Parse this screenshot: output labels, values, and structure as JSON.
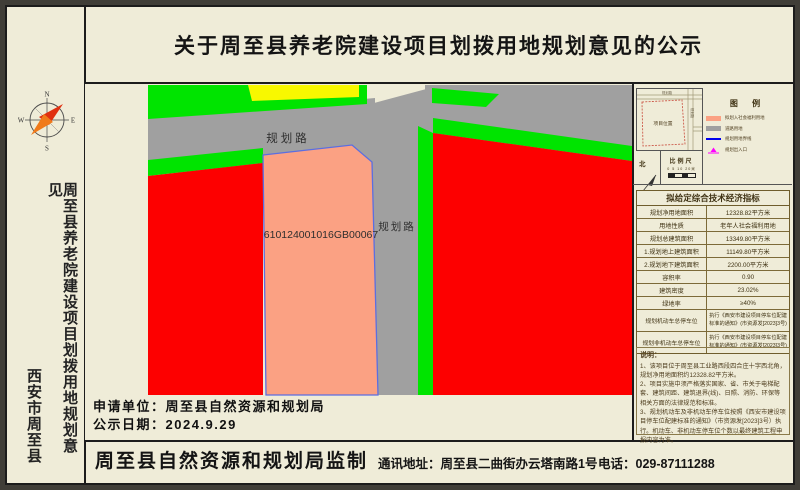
{
  "title": "关于周至县养老院建设项目划拨用地规划意见的公示",
  "sidebar": {
    "project_vertical": "周至县养老院建设项目划拨用地规划意见",
    "city_vertical": "西安市周至县",
    "compass": {
      "n": "N",
      "e": "E",
      "s": "S",
      "w": "W"
    }
  },
  "map": {
    "parcel_code": "610124001016GB00067",
    "road_top": "规划路",
    "road_right": "规划路"
  },
  "inset": {
    "label": "项目位置",
    "road_top": "规划路",
    "road_right": "规划路"
  },
  "north_label": "北",
  "scale": {
    "label": "比例尺",
    "ticks": "0 5 10  20米"
  },
  "legend": {
    "title": "图  例",
    "items": [
      {
        "swatch": "parcel-fill",
        "label": "拟划入社会福利用地"
      },
      {
        "swatch": "road-fill",
        "label": "道路用地"
      },
      {
        "swatch": "boundary-line",
        "label": "规划用地界线"
      },
      {
        "swatch": "entrance-symbol",
        "label": "规划出入口"
      }
    ]
  },
  "indicators": {
    "title": "拟给定综合技术经济指标",
    "rows": [
      {
        "label": "规划净用地面积",
        "value": "12328.82平方米"
      },
      {
        "label": "用地性质",
        "value": "老年人社会福利用地"
      },
      {
        "label": "规划总建筑面积",
        "value": "13349.80平方米"
      },
      {
        "label": "1.规划地上建筑面积",
        "value": "11149.80平方米"
      },
      {
        "label": "2.规划地下建筑面积",
        "value": "2200.00平方米"
      },
      {
        "label": "容积率",
        "value": "0.90"
      },
      {
        "label": "建筑密度",
        "value": "23.02%"
      },
      {
        "label": "绿地率",
        "value": "≥40%"
      },
      {
        "label": "规划机动车总停车位",
        "value": "执行《西安市建设项目停车位配建标准的通知》(市资源发[2023]3号)"
      },
      {
        "label": "规划非机动车总停车位",
        "value": "执行《西安市建设项目停车位配建标准的通知》(市资源发[2023]3号)"
      }
    ]
  },
  "notes": {
    "title": "说明：",
    "lines": [
      "1、该项目位于周至县工业路西段四合庄十字西北角，规划净用地面积约12328.82平方米。",
      "2、项目实施中须严格落实国家、省、市关于电梯配套、建筑间距、建筑退界(线)、日照、消防、环保等相关方面的法律规范和标准。",
      "3、规划机动车及非机动车停车位按照《西安市建设项目停车位配建标准的通知》（市资源发[2023]3号）执行。机动车、非机动车停车位个数以最终建筑工程申报内容为准。"
    ]
  },
  "apply": {
    "line1": "申请单位：周至县自然资源和规划局",
    "line2": "公示日期：2024.9.29"
  },
  "footer": {
    "producer": "周至县自然资源和规划局监制",
    "address": "通讯地址：周至县二曲街办云塔南路1号",
    "phone": "电话：029-87111288"
  },
  "colors": {
    "paper": "#efecd8",
    "green": "#00e400",
    "yellow": "#f8f800",
    "road_gray": "#a0a0a0",
    "red": "#fd0000",
    "parcel_salmon": "#fba183",
    "parcel_border_blue": "#5b6ee1",
    "legend_blue": "#0000ee",
    "entrance_magenta": "#ff00ff"
  }
}
